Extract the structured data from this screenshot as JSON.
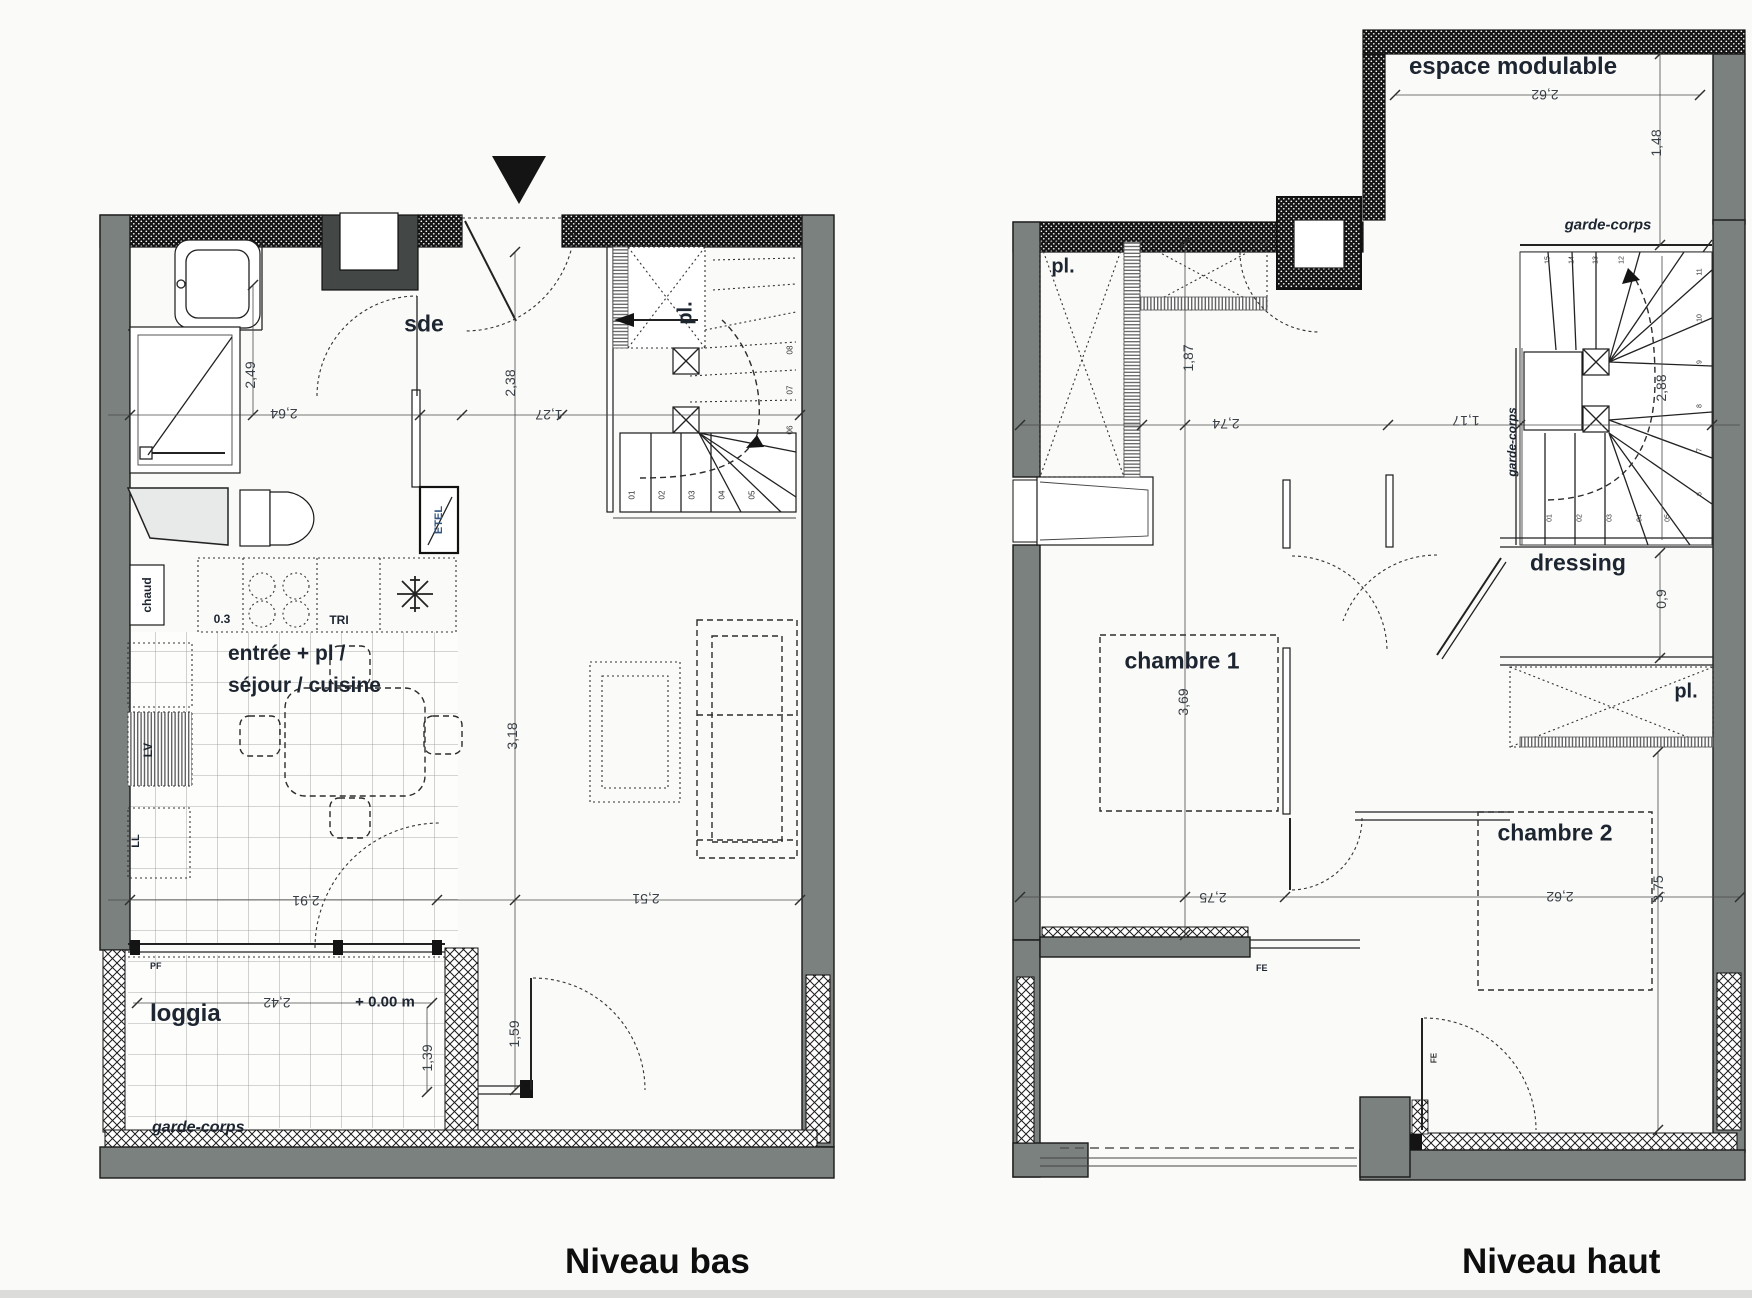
{
  "colors": {
    "wall_gray": "#7b817e",
    "line_black": "#1a1a1a",
    "label_dark": "#1d2531",
    "etel_blue": "#33557f"
  },
  "titles": {
    "lower": "Niveau bas",
    "upper": "Niveau haut"
  },
  "lower": {
    "rooms": {
      "sde": "sde",
      "stair_closet": "pl.",
      "living1": "entrée + pl /",
      "living2": "séjour / cuisine",
      "loggia": "loggia"
    },
    "labels": {
      "garde_corps": "garde-corps",
      "chaud": "chaud",
      "lv": "LV",
      "ll": "LL",
      "tri": "TRI",
      "etel": "ETEL",
      "hob": "0.3",
      "level": "+ 0.00 m",
      "pf": "PF"
    },
    "dims": {
      "w_sde": "2,64",
      "h_sde": "2,49",
      "h_entry": "2,38",
      "w_entry": "1,27",
      "h_living": "3,18",
      "w_kitchen": "2,91",
      "w_living": "2,51",
      "w_loggia": "2,42",
      "h_loggia": "1,39",
      "h_door": "1,59"
    },
    "stair_numbers": [
      "01",
      "02",
      "03",
      "04",
      "05",
      "06",
      "07",
      "08"
    ]
  },
  "upper": {
    "rooms": {
      "espace": "espace modulable",
      "pl_top": "pl.",
      "pl_right": "pl.",
      "dressing": "dressing",
      "chambre1": "chambre 1",
      "chambre2": "chambre 2"
    },
    "labels": {
      "garde_corps_top": "garde-corps",
      "garde_corps_side": "garde-corps",
      "fe1": "FE",
      "fe2": "FE"
    },
    "dims": {
      "w_espace": "2,62",
      "h_espace": "1,48",
      "h_pl": "1,87",
      "w_ch1_top": "2,74",
      "w_landing": "1,17",
      "h_stair": "2,88",
      "h_ch1": "3,69",
      "h_dressing": "0,9",
      "w_ch1": "2,75",
      "w_ch2": "2,62",
      "h_ch2": "3,75"
    },
    "stair_top": [
      "15",
      "14",
      "13",
      "12"
    ],
    "stair_right": [
      "11",
      "10",
      "9",
      "8",
      "7",
      "6"
    ],
    "stair_bottom": [
      "01",
      "02",
      "03",
      "04",
      "05"
    ]
  }
}
